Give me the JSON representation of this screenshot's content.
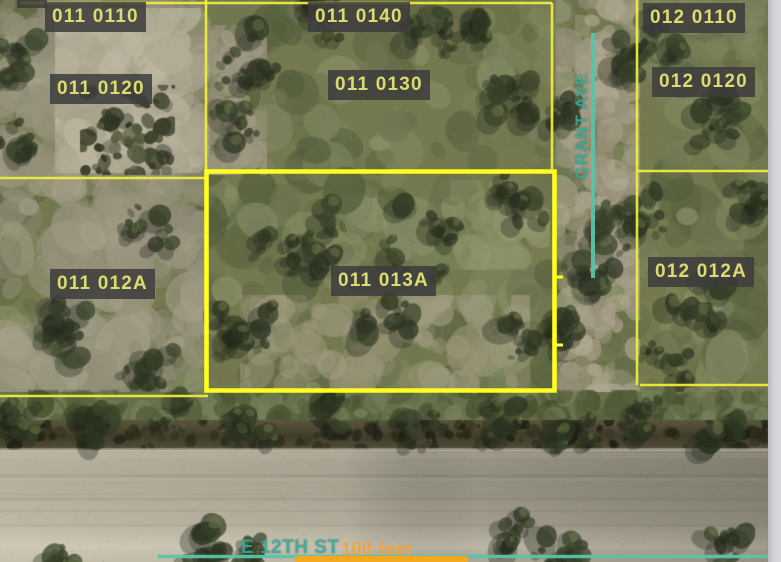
{
  "map": {
    "parcels": [
      {
        "id": "011 0110",
        "x": 45,
        "y": 2,
        "highlighted": false
      },
      {
        "id": "011 0140",
        "x": 308,
        "y": 2,
        "highlighted": false
      },
      {
        "id": "012 0110",
        "x": 643,
        "y": 3,
        "highlighted": false
      },
      {
        "id": "011 0120",
        "x": 50,
        "y": 74,
        "highlighted": false
      },
      {
        "id": "011 0130",
        "x": 328,
        "y": 70,
        "highlighted": false
      },
      {
        "id": "012 0120",
        "x": 652,
        "y": 67,
        "highlighted": false
      },
      {
        "id": "011 012A",
        "x": 50,
        "y": 269,
        "highlighted": false
      },
      {
        "id": "011 013A",
        "x": 331,
        "y": 266,
        "highlighted": true
      },
      {
        "id": "012 012A",
        "x": 648,
        "y": 257,
        "highlighted": false
      }
    ],
    "highlighted_parcel": "011 013A",
    "streets": [
      {
        "name": "GRANT AVE",
        "orientation": "vertical"
      },
      {
        "name": "E 12TH ST",
        "orientation": "horizontal"
      }
    ],
    "scale": {
      "label": "100 feet"
    },
    "colors": {
      "parcel_line": "#ecec3c",
      "highlight_line": "#ffff20",
      "street_line": "#5bc2ab",
      "street_text": "#3ba797",
      "scale_bar": "#f4a820",
      "scale_text": "#f1a33c",
      "label_bg": "#3c3c3c",
      "label_text": "#dcdb72"
    }
  }
}
